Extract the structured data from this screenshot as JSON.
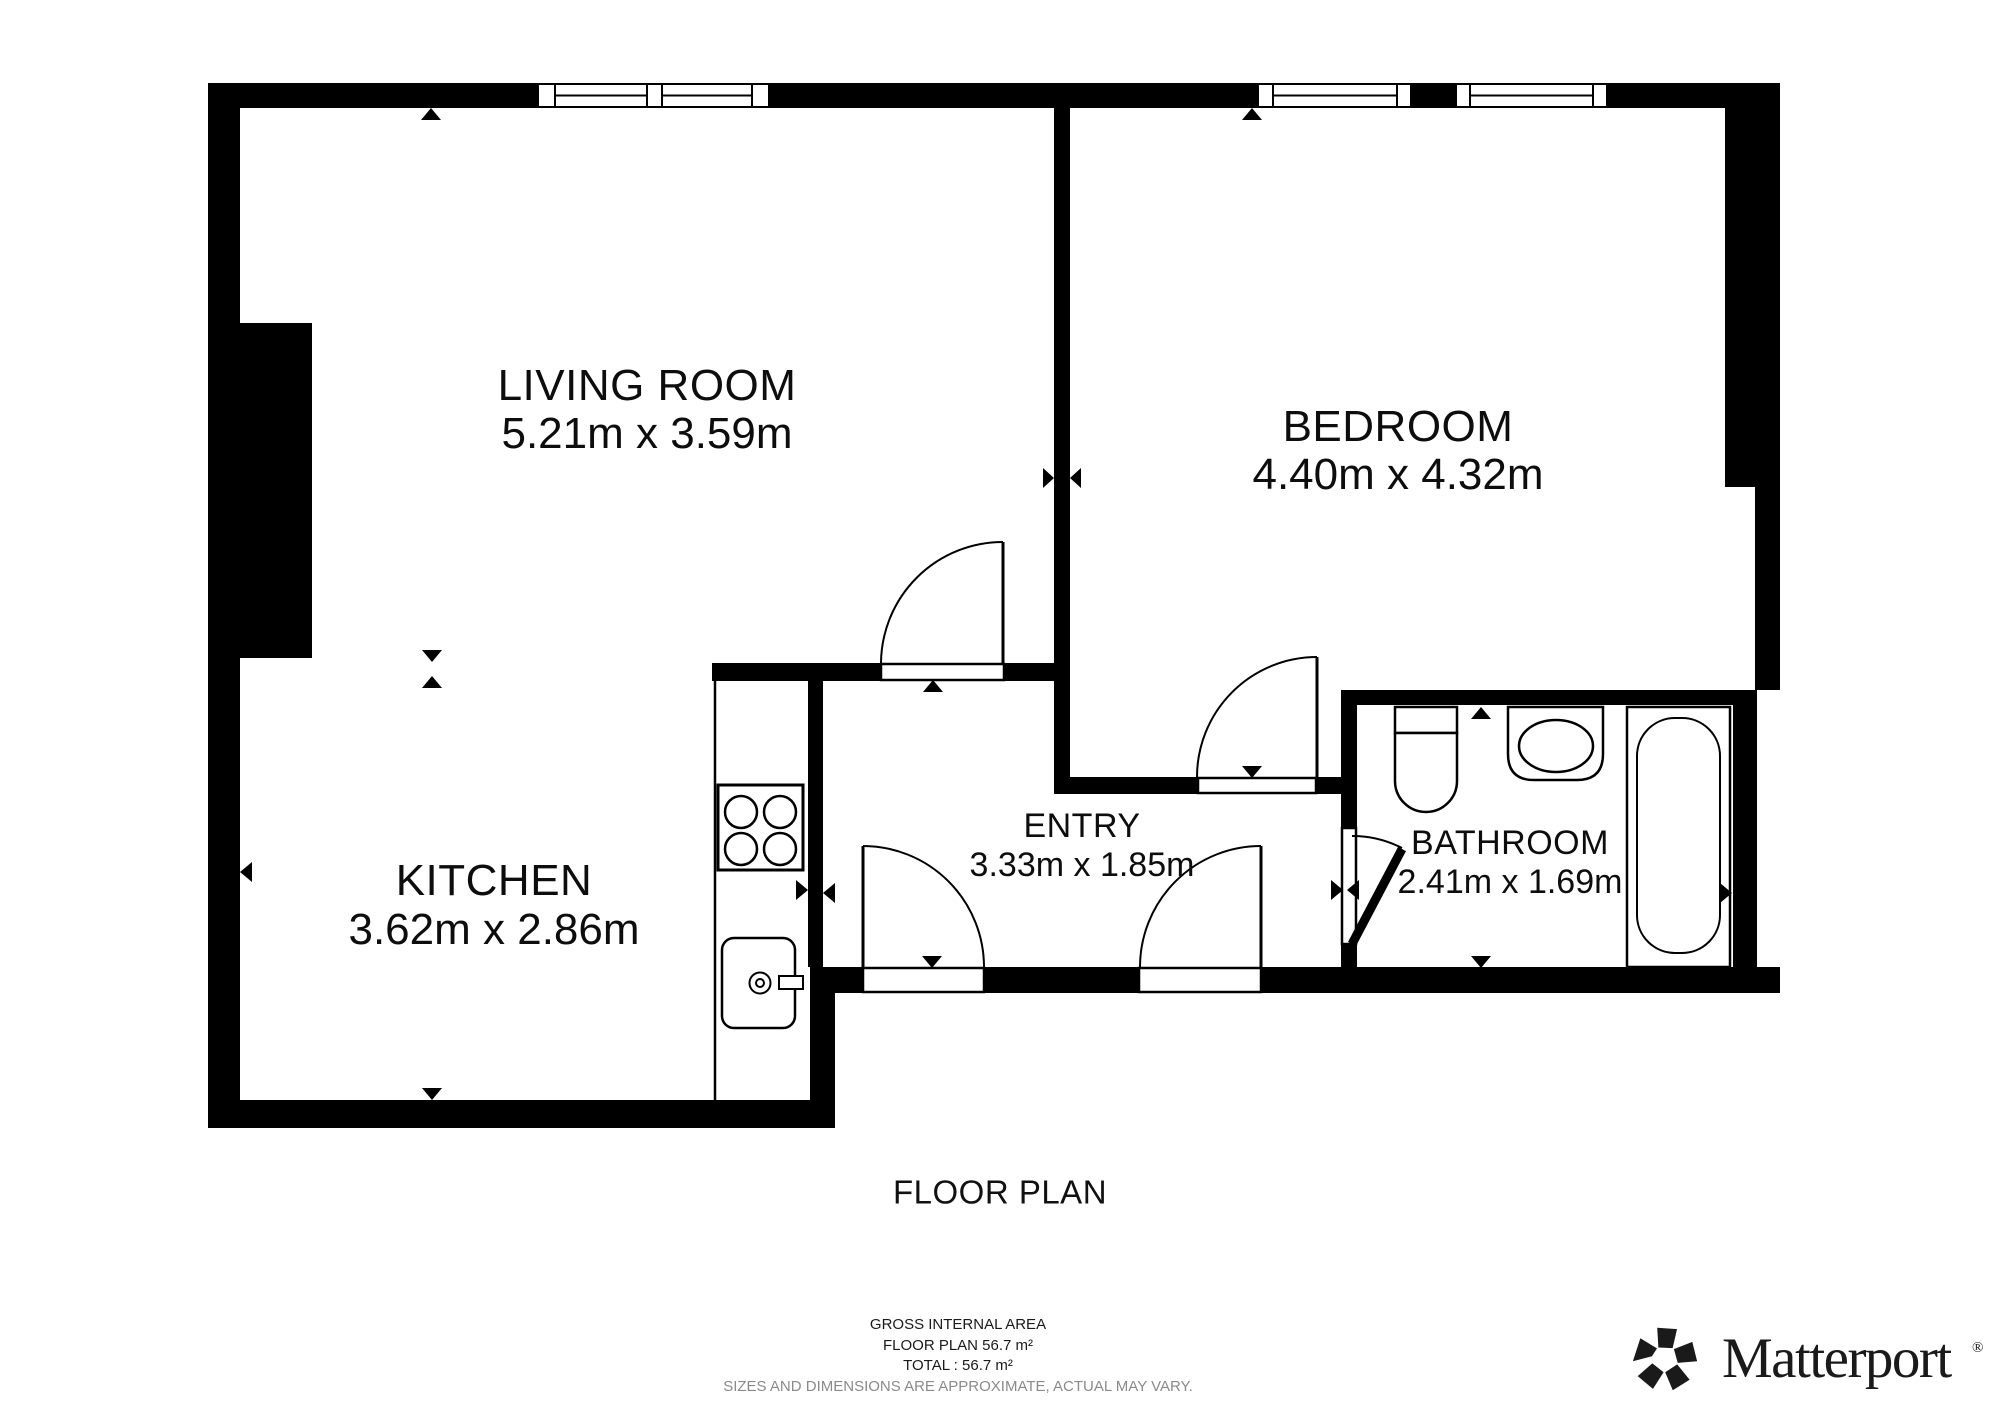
{
  "title": "FLOOR PLAN",
  "rooms": [
    {
      "name": "LIVING ROOM",
      "dims": "5.21m x 3.59m"
    },
    {
      "name": "BEDROOM",
      "dims": "4.40m x 4.32m"
    },
    {
      "name": "KITCHEN",
      "dims": "3.62m x 2.86m"
    },
    {
      "name": "ENTRY",
      "dims": "3.33m x 1.85m"
    },
    {
      "name": "BATHROOM",
      "dims": "2.41m x 1.69m"
    }
  ],
  "summary": {
    "line1": "GROSS INTERNAL AREA",
    "line2": "FLOOR PLAN 56.7 m²",
    "line3": "TOTAL :  56.7 m²",
    "disclaimer": "SIZES AND DIMENSIONS ARE APPROXIMATE, ACTUAL MAY VARY."
  },
  "branding": {
    "wordmark": "Matterport",
    "registered": "®"
  },
  "colors": {
    "wall": "#000000",
    "label_text": "#0d0d0d",
    "disclaimer_text": "#8a8a8a",
    "logo": "#1a1a1a"
  }
}
